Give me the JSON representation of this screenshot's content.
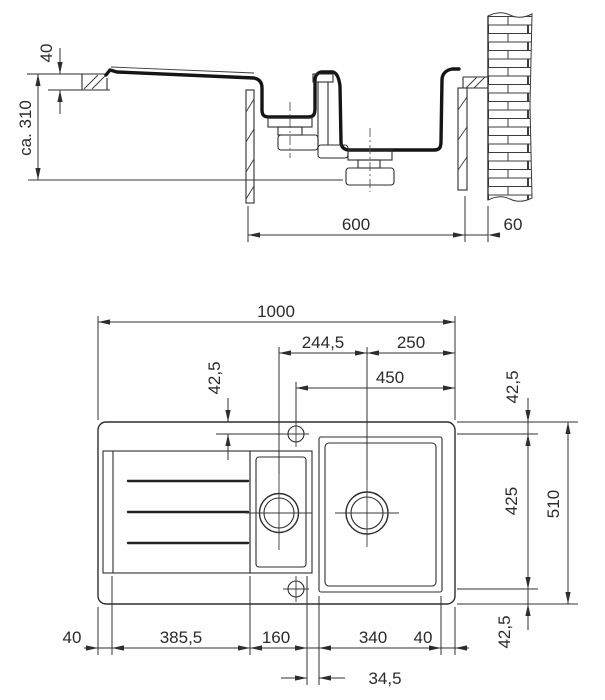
{
  "drawing": {
    "section": {
      "rim_height": "40",
      "clearance_depth": "ca. 310",
      "cabinet_width": "600",
      "wall_clearance": "60"
    },
    "plan": {
      "overall_width": "1000",
      "drain_center_spacing": "244,5",
      "drain_to_right_edge": "250",
      "tap_line_to_right_edge": "450",
      "tap_line_offset": "42,5",
      "right_top_margin": "42,5",
      "tap_holes_span": "425",
      "overall_depth": "510",
      "right_bottom_margin": "42,5",
      "left_margin": "40",
      "drainboard_width": "385,5",
      "small_bowl_width": "160",
      "bowl_gap": "34,5",
      "main_bowl_width": "340",
      "right_margin": "40"
    }
  }
}
